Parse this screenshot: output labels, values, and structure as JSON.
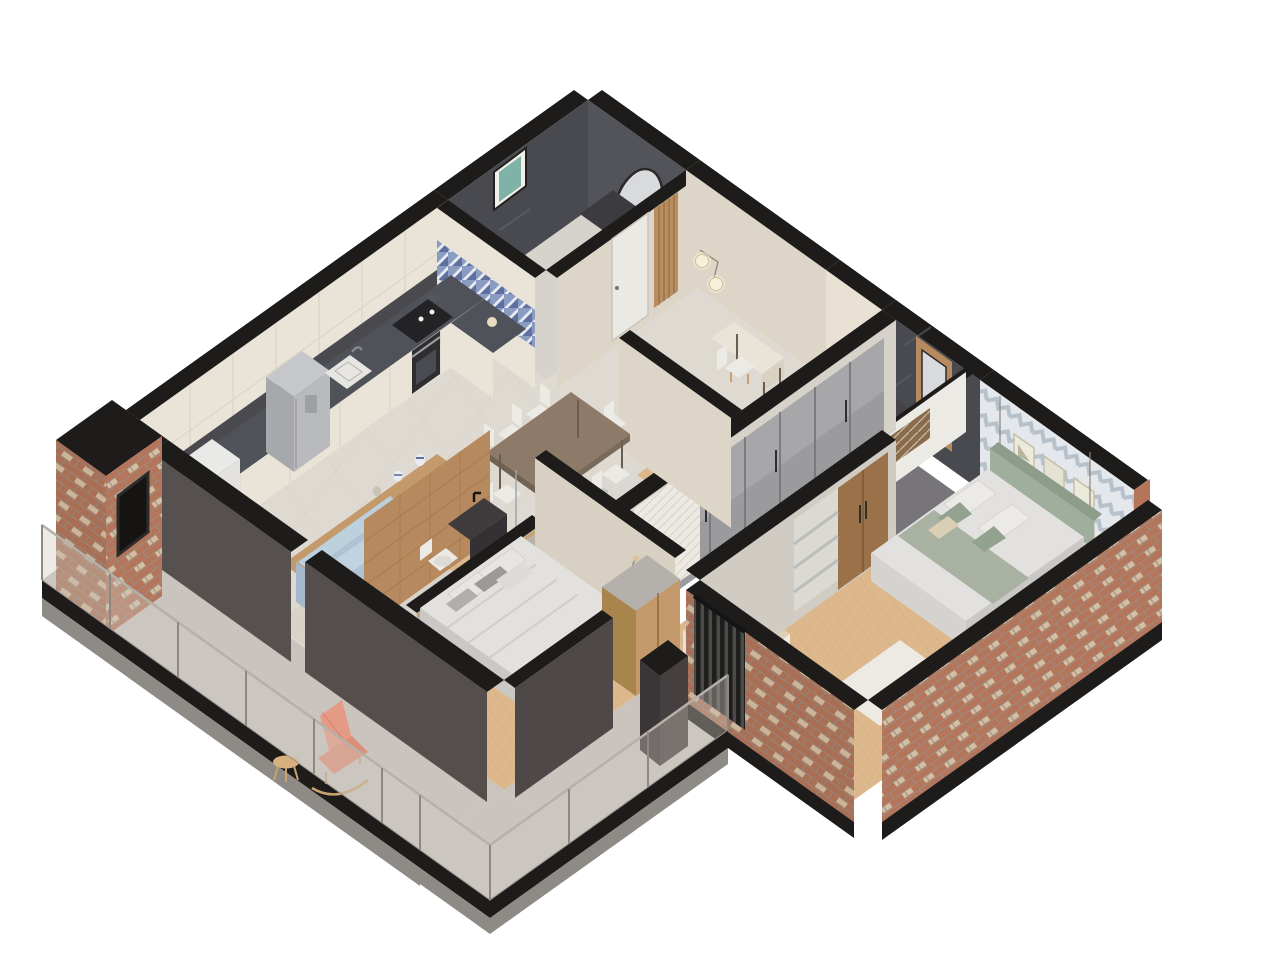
{
  "meta": {
    "title": "Isometric 3D apartment floor plan render",
    "view": "cutaway axonometric from south",
    "background": "#ffffff"
  },
  "rooms": [
    {
      "name": "kitchen",
      "features": [
        "cream upper cabinets",
        "dark stone counter and backsplash",
        "steel fridge",
        "built-in oven",
        "black cooktop with pot",
        "white sink",
        "washing machine",
        "blue mosaic backsplash",
        "wood breakfast bar with vases"
      ]
    },
    {
      "name": "powder-bathroom",
      "features": [
        "dark marble walls",
        "oval mirror",
        "framed seascape art",
        "dark floating vanity",
        "purple flowers"
      ]
    },
    {
      "name": "entry-hall",
      "features": [
        "white door",
        "vertical wood slat panel",
        "brass double-globe wall lamp",
        "console desk with chair"
      ]
    },
    {
      "name": "living-dining",
      "features": [
        "light blue sofa",
        "shaggy rug",
        "dark wood dining table",
        "six white chairs",
        "large tile floor"
      ]
    },
    {
      "name": "master-bedroom",
      "features": [
        "double bed with gray bedding",
        "leather bench",
        "nightstand with pampas",
        "wood wardrobe",
        "wood plank floor",
        "dark charcoal walls"
      ]
    },
    {
      "name": "master-ensuite",
      "features": [
        "wood tile wall",
        "dark granite floating sink",
        "toilet",
        "glass divider"
      ]
    },
    {
      "name": "shower-bathroom",
      "features": [
        "concrete sink counter",
        "glass shower door",
        "gray tiles"
      ]
    },
    {
      "name": "walk-in-closet",
      "features": [
        "gray glass-front wardrobes",
        "rattan lattice cabinet",
        "day bed with beige blanket",
        "white herringbone panel wall"
      ]
    },
    {
      "name": "second-bathroom",
      "features": [
        "dark marble walls",
        "wood panel",
        "rectangular mirror",
        "dark vanity",
        "toilet"
      ]
    },
    {
      "name": "second-bedroom",
      "features": [
        "chevron wallpaper",
        "grid of six art frames",
        "bed with sage green bedding",
        "globe pendant lights",
        "round side table",
        "wood wardrobe with open shelves"
      ]
    },
    {
      "name": "balcony",
      "features": [
        "glass railing with metal posts",
        "concrete tile floor",
        "salmon rocking chair",
        "round wood side table",
        "black slat screen",
        "brick chimney with fireplace"
      ]
    }
  ],
  "palette": {
    "wall_top": "#1d1c1b",
    "wall_dark": "#56504f",
    "wall_beige": "#ddd5c7",
    "marble_dark": "#494a50",
    "brick": "#b4755a",
    "brick_light": "#d9cdb0",
    "chevron_bg": "#e4e8ec",
    "chevron_line": "#b6c1cb",
    "wood_warm": "#c49a6c",
    "wood_floor": "#dcb88c",
    "tile_floor": "#dedad2",
    "bath_floor": "#d6d3cd",
    "balcony_floor": "#c9c5be",
    "base_dark": "#2a2927",
    "cabinet_cream": "#eae4d8",
    "counter_dark": "#50525a",
    "steel": "#b9babd",
    "sofa_blue": "#aec3d4",
    "sofa_blue_light": "#c1d2e0",
    "rug": "#d8d3c8",
    "table_wood": "#8d7a69",
    "chair_white": "#eceae5",
    "bed_white": "#e2e1df",
    "bed_sage": "#a9b2a2",
    "headboard_sage": "#9fae9d",
    "bench_leather": "#9a6a4b",
    "salmon_chair": "#e59a85",
    "glass_rail": "#cfc8bf",
    "slat_screen": "#262626",
    "mirror": "#d9dadb",
    "lamp_glow": "#f6efd9",
    "wood_slat": "#b98d5f",
    "glass_wardrobe": "#9b9a9d",
    "day_bed": "#ddd0b5",
    "wood_tile_wall": "#b68a5e",
    "art_teal": "#7fb3a8"
  }
}
